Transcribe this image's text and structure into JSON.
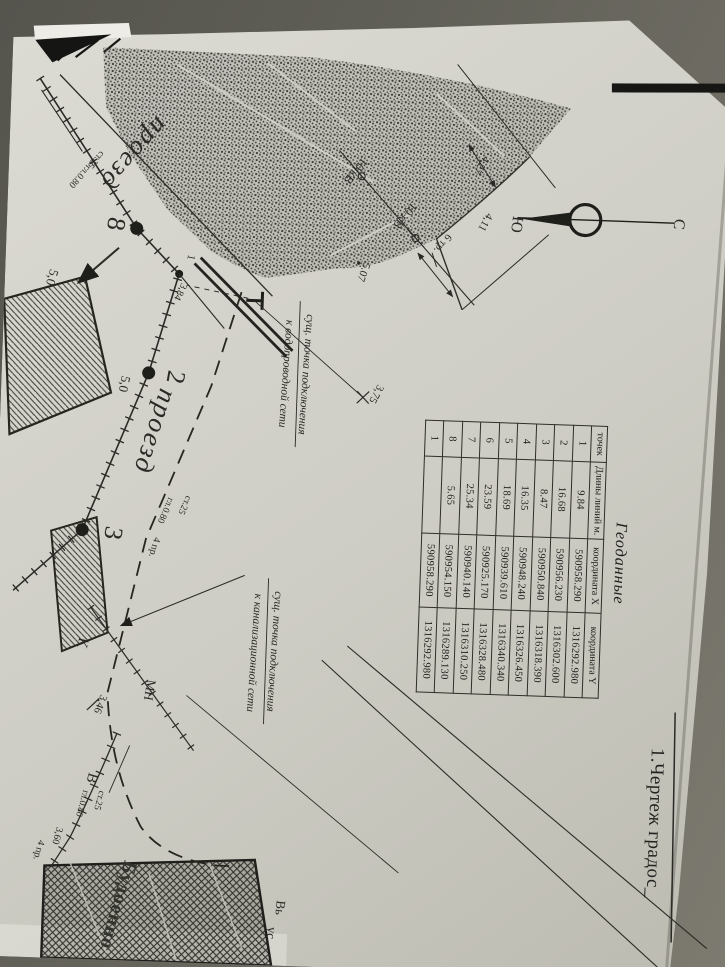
{
  "document": {
    "title": "1.Чертеж градос_",
    "edge_label_1": "Вь",
    "edge_label_2": "ус."
  },
  "compass": {
    "north": "С",
    "south": "Ю"
  },
  "geodata_table": {
    "title": "Геоданные",
    "col_points": "точек",
    "col_lengths": "Длины линий м.",
    "col_x": "координата X",
    "col_y": "координата Y",
    "rows": [
      {
        "n": "1",
        "len": "9.84",
        "x": "590958.290",
        "y": "1316292.980"
      },
      {
        "n": "2",
        "len": "16.68",
        "x": "590956.230",
        "y": "1316302.600"
      },
      {
        "n": "3",
        "len": "8.47",
        "x": "590950.840",
        "y": "1316318.390"
      },
      {
        "n": "4",
        "len": "16.35",
        "x": "590948.240",
        "y": "1316326.450"
      },
      {
        "n": "5",
        "len": "18.69",
        "x": "590939.610",
        "y": "1316340.340"
      },
      {
        "n": "6",
        "len": "23.59",
        "x": "590925.170",
        "y": "1316328.480"
      },
      {
        "n": "7",
        "len": "25.34",
        "x": "590940.140",
        "y": "1316310.250"
      },
      {
        "n": "8",
        "len": "5.65",
        "x": "590954.150",
        "y": "1316289.130"
      },
      {
        "n": "1",
        "len": "",
        "x": "590958.290",
        "y": "1316292.980"
      }
    ]
  },
  "plan_labels": {
    "road1": "проезд",
    "road2": "проезд",
    "st25_1": "ст.25",
    "v_gl_1": "В гл.0.80",
    "pt8": "8",
    "dim50a": "5,0",
    "pt1": "1",
    "d384": "3,84",
    "pt2": "2",
    "dim50b": "5,0",
    "pt3": "3",
    "st25_2": "ст.25",
    "gl080_2": "гл.0.80",
    "pr4_1": "4 пр.",
    "water_line1": "сущ. точка подключения",
    "water_line2": "к водопроводной сети",
    "sewer_line1": "сущ. точка подключения",
    "sewer_line2": "к канализационной сети",
    "d375": "3,75",
    "kv10_1": "10 кВ",
    "kv10_2": "10 кВ",
    "tr6": "6 тр.",
    "d427": "4,27",
    "d411": "4,11",
    "d507": "5.07",
    "k_well": "К",
    "mn": "МН",
    "d346": "3,46",
    "v_big": "В",
    "gl080_3": "гл.0.80",
    "st25_3": "ст.25",
    "d360": "3,60",
    "pr4_2": "4 пр.",
    "building_name": "Будоенно"
  },
  "colors": {
    "paper": "#d4d3cc",
    "ink": "#2a2a26",
    "background": "#605f57"
  }
}
